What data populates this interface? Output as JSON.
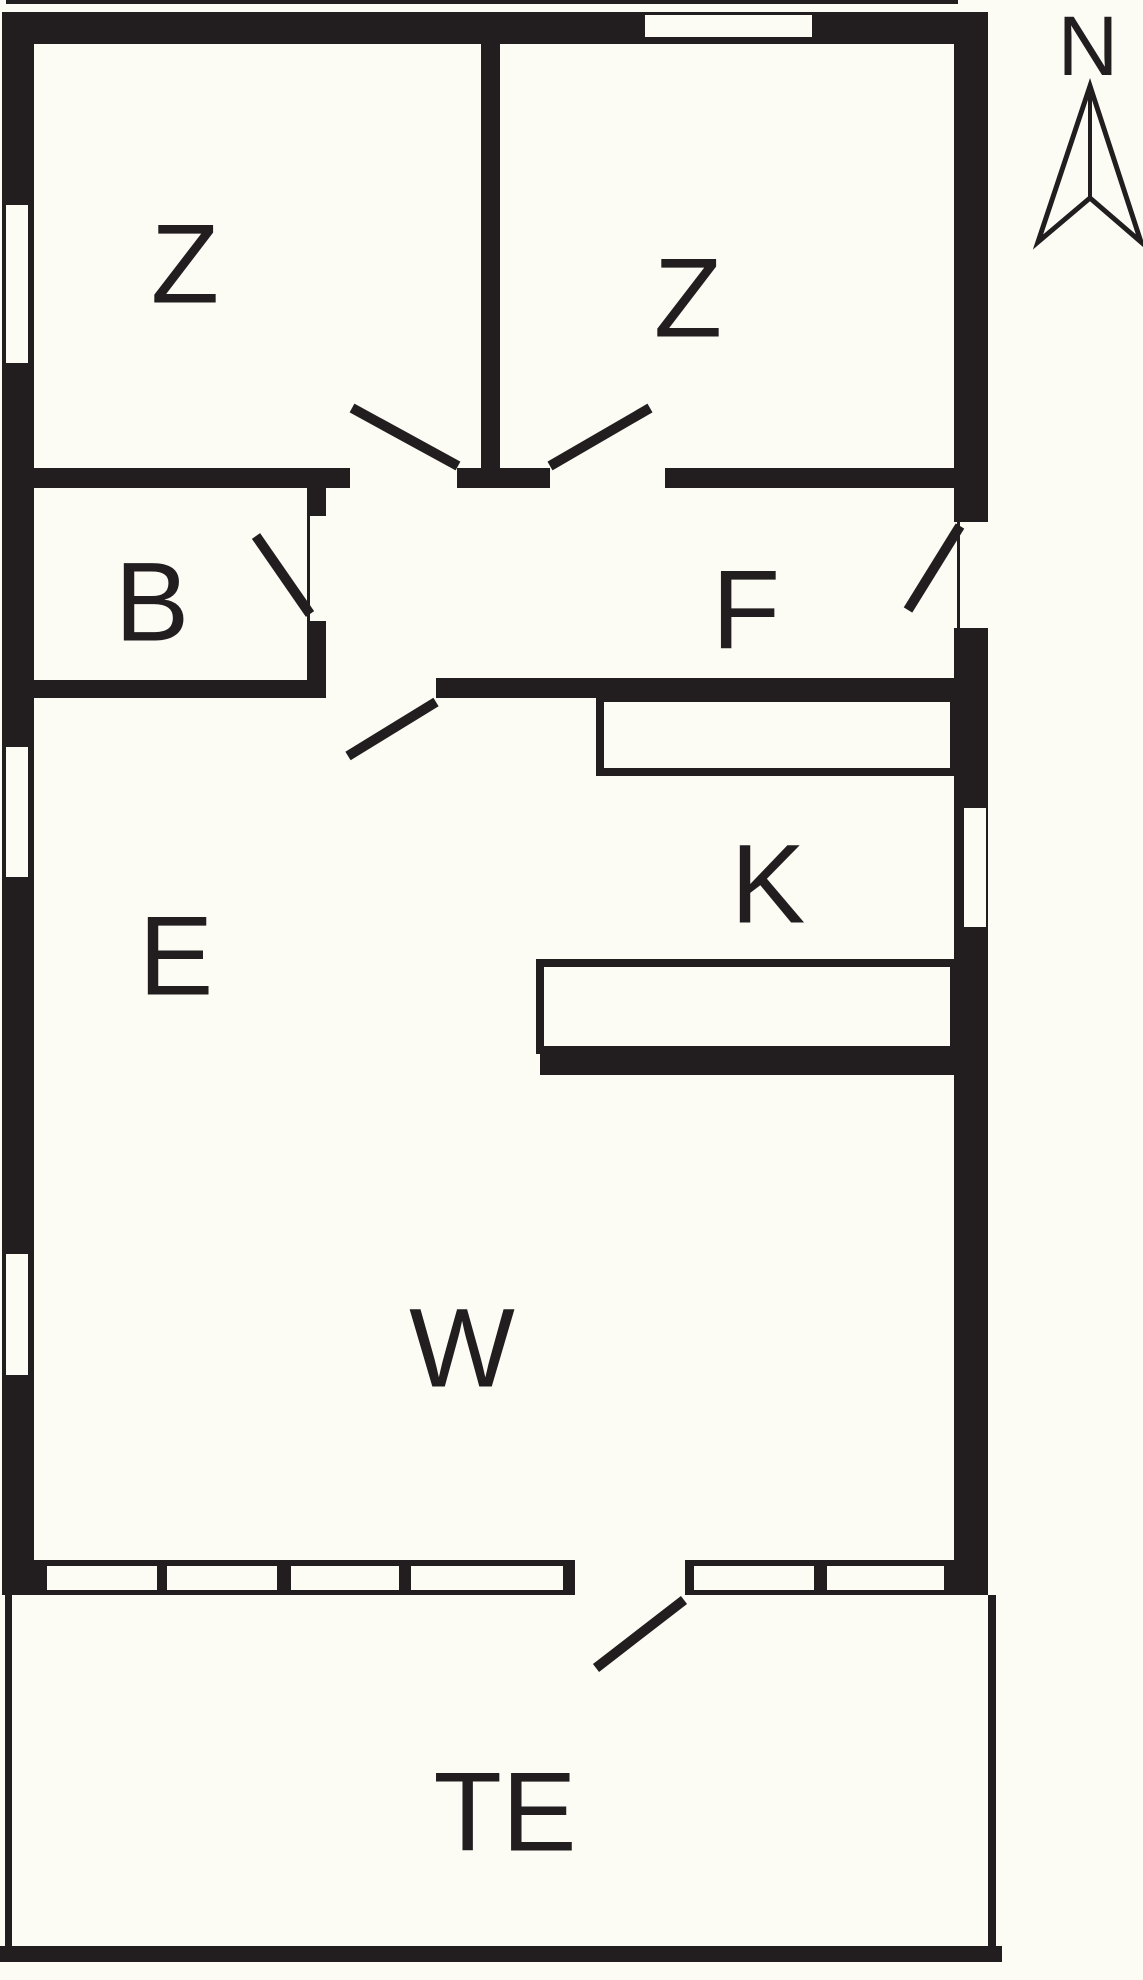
{
  "meta": {
    "kind": "floor-plan",
    "description": "Black-and-white architectural floor plan with compass rose"
  },
  "colors": {
    "paper": "#fcfcf5",
    "ink": "#221e1f"
  },
  "compass": {
    "label": "N",
    "label_x": 1088,
    "label_y": 46,
    "label_size": 84,
    "arrow_points": "1090,86 1038,242 1090,198 1141,242",
    "center_line": {
      "x1": 1090,
      "y1": 86,
      "x2": 1090,
      "y2": 198
    }
  },
  "rooms": [
    {
      "id": "bedroom-left",
      "label": "Z",
      "x": 185,
      "y": 264,
      "size": 112
    },
    {
      "id": "bedroom-right",
      "label": "Z",
      "x": 688,
      "y": 298,
      "size": 112
    },
    {
      "id": "bathroom",
      "label": "B",
      "x": 152,
      "y": 602,
      "size": 112
    },
    {
      "id": "hall",
      "label": "F",
      "x": 746,
      "y": 610,
      "size": 112
    },
    {
      "id": "dining",
      "label": "E",
      "x": 176,
      "y": 956,
      "size": 112
    },
    {
      "id": "kitchen",
      "label": "K",
      "x": 768,
      "y": 884,
      "size": 112
    },
    {
      "id": "living",
      "label": "W",
      "x": 462,
      "y": 1348,
      "size": 112
    },
    {
      "id": "terrace",
      "label": "TE",
      "x": 505,
      "y": 1812,
      "size": 112
    }
  ],
  "plan": {
    "width": 1143,
    "height": 1980,
    "wall_stroke": 10,
    "counter_stroke": 8,
    "walls": [
      {
        "name": "roof-edge-line",
        "x": 6,
        "y": 0,
        "w": 952,
        "h": 4
      },
      {
        "name": "wall-top",
        "x": 2,
        "y": 12,
        "w": 986,
        "h": 32
      },
      {
        "name": "wall-left",
        "x": 2,
        "y": 12,
        "w": 32,
        "h": 1583
      },
      {
        "name": "wall-right",
        "x": 954,
        "y": 12,
        "w": 34,
        "h": 1583
      },
      {
        "name": "wall-bottom",
        "x": 2,
        "y": 1560,
        "w": 986,
        "h": 35
      },
      {
        "name": "wall-bedroom-divider",
        "x": 481,
        "y": 44,
        "w": 19,
        "h": 424
      },
      {
        "name": "wall-hall-top-left",
        "x": 34,
        "y": 468,
        "w": 316,
        "h": 20
      },
      {
        "name": "wall-hall-top-stub",
        "x": 457,
        "y": 468,
        "w": 93,
        "h": 20
      },
      {
        "name": "wall-hall-top-right",
        "x": 665,
        "y": 468,
        "w": 289,
        "h": 20
      },
      {
        "name": "wall-bath-right-upper",
        "x": 307,
        "y": 488,
        "w": 19,
        "h": 28
      },
      {
        "name": "wall-bath-right-lower",
        "x": 307,
        "y": 621,
        "w": 19,
        "h": 59
      },
      {
        "name": "wall-bath-bottom",
        "x": 34,
        "y": 680,
        "w": 292,
        "h": 18
      },
      {
        "name": "wall-hall-bottom",
        "x": 436,
        "y": 678,
        "w": 518,
        "h": 20
      },
      {
        "name": "wall-kitchen-bottom",
        "x": 540,
        "y": 1050,
        "w": 414,
        "h": 25
      }
    ],
    "windows": [
      {
        "name": "window-bedroom-right-top",
        "x": 645,
        "y": 15,
        "w": 167,
        "h": 22
      },
      {
        "name": "window-bedroom-left",
        "x": 6,
        "y": 205,
        "w": 22,
        "h": 158
      },
      {
        "name": "window-dining-left",
        "x": 6,
        "y": 747,
        "w": 22,
        "h": 130
      },
      {
        "name": "window-living-left",
        "x": 6,
        "y": 1254,
        "w": 22,
        "h": 121
      },
      {
        "name": "opening-entry-door",
        "x": 954,
        "y": 522,
        "w": 34,
        "h": 106
      },
      {
        "name": "window-kitchen-right",
        "x": 964,
        "y": 808,
        "w": 22,
        "h": 119
      },
      {
        "name": "window-living-bottom-1",
        "x": 47,
        "y": 1566,
        "w": 110,
        "h": 24
      },
      {
        "name": "window-living-bottom-2",
        "x": 167,
        "y": 1566,
        "w": 110,
        "h": 24
      },
      {
        "name": "window-living-bottom-3",
        "x": 291,
        "y": 1566,
        "w": 108,
        "h": 24
      },
      {
        "name": "window-living-bottom-4",
        "x": 411,
        "y": 1566,
        "w": 152,
        "h": 24
      },
      {
        "name": "opening-terrace-door",
        "x": 575,
        "y": 1560,
        "w": 110,
        "h": 35
      },
      {
        "name": "window-living-bottom-5",
        "x": 694,
        "y": 1566,
        "w": 120,
        "h": 24
      },
      {
        "name": "window-living-bottom-6",
        "x": 827,
        "y": 1566,
        "w": 117,
        "h": 24
      }
    ],
    "frames": [
      {
        "name": "frame-bath-door",
        "x": 307,
        "y": 516,
        "w": 3,
        "h": 105
      },
      {
        "name": "frame-entry-door",
        "x": 957,
        "y": 522,
        "w": 3,
        "h": 106
      }
    ],
    "counters": [
      {
        "name": "kitchen-counter-upper",
        "x": 600,
        "y": 698,
        "w": 354,
        "h": 74
      },
      {
        "name": "kitchen-counter-lower",
        "x": 540,
        "y": 963,
        "w": 414,
        "h": 87
      }
    ],
    "door_swings": [
      {
        "name": "door-swing-bedroom-left",
        "x1": 458,
        "y1": 466,
        "x2": 352,
        "y2": 408
      },
      {
        "name": "door-swing-bedroom-right",
        "x1": 550,
        "y1": 466,
        "x2": 650,
        "y2": 408
      },
      {
        "name": "door-swing-bathroom",
        "x1": 310,
        "y1": 614,
        "x2": 256,
        "y2": 536
      },
      {
        "name": "door-swing-hall-dining",
        "x1": 436,
        "y1": 702,
        "x2": 348,
        "y2": 756
      },
      {
        "name": "door-swing-entry",
        "x1": 960,
        "y1": 526,
        "x2": 908,
        "y2": 610
      },
      {
        "name": "door-swing-terrace",
        "x1": 684,
        "y1": 1600,
        "x2": 596,
        "y2": 1668
      }
    ],
    "terrace_edges": [
      {
        "name": "terrace-edge-left",
        "x": 5,
        "y": 1595,
        "w": 7,
        "h": 353
      },
      {
        "name": "terrace-edge-right",
        "x": 988,
        "y": 1595,
        "w": 8,
        "h": 353
      },
      {
        "name": "terrace-edge-bottom",
        "x": 0,
        "y": 1946,
        "w": 1002,
        "h": 16
      }
    ]
  }
}
